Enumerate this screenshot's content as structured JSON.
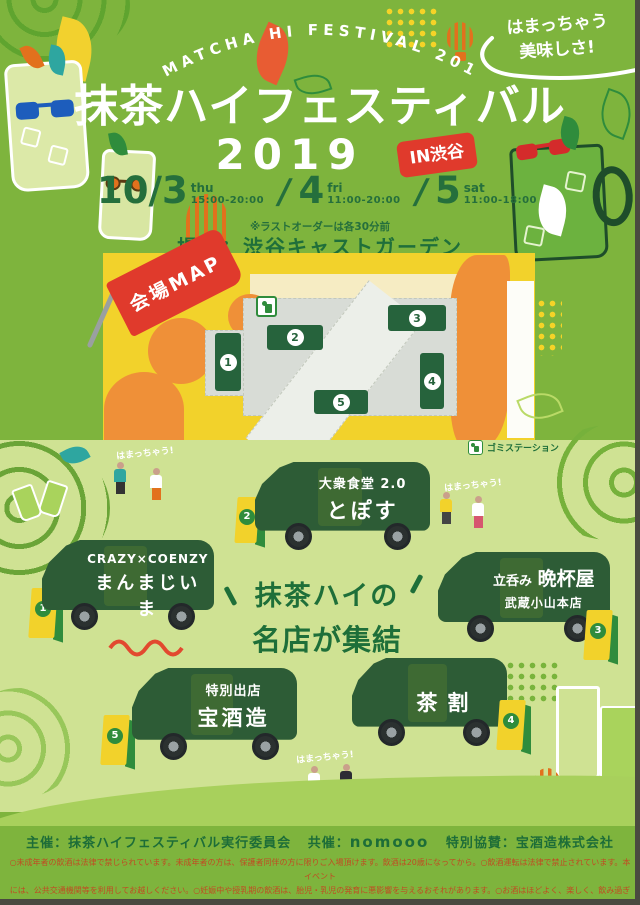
{
  "header": {
    "arch_text": "MATCHA HI FESTIVAL 2019",
    "bubble_line1": "はまっちゃう",
    "bubble_line2": "美味しさ!",
    "title": "抹茶ハイフェスティバル",
    "year": "2019",
    "location_badge": "IN渋谷",
    "dates": [
      {
        "day": "10/3",
        "weekday": "thu",
        "time": "15:00-20:00"
      },
      {
        "day": "4",
        "weekday": "fri",
        "time": "11:00-20:00"
      },
      {
        "day": "5",
        "weekday": "sat",
        "time": "11:00-18:00"
      }
    ],
    "date_separator": "/",
    "last_order_note": "※ラストオーダーは各30分前",
    "venue": "場所：渋谷キャストガーデン"
  },
  "map": {
    "flag_label": "会場MAP",
    "booths": [
      "1",
      "2",
      "3",
      "4",
      "5"
    ],
    "legend_label": "ゴミステーション"
  },
  "center_headline": {
    "line1": "抹茶ハイの",
    "line2": "名店が集結"
  },
  "catchphrase": "はまっちゃう!",
  "trucks": [
    {
      "number": "1",
      "line1": "CRAZY×COENZY",
      "line2": "まんまじいま"
    },
    {
      "number": "2",
      "line1": "大衆食堂 2.0",
      "line2": "とぽす"
    },
    {
      "number": "3",
      "prefix": "立呑み",
      "name": "晩杯屋",
      "sub": "武蔵小山本店"
    },
    {
      "number": "4",
      "line2": "茶割"
    },
    {
      "number": "5",
      "line1": "特別出店",
      "line2": "宝酒造"
    }
  ],
  "footer": {
    "credits_part1": "主催：抹茶ハイフェスティバル実行委員会",
    "credits_part2_label": "共催：",
    "credits_part2_value": "nomooo",
    "credits_part3": "特別協賛：宝酒造株式会社",
    "fine_print": [
      "○未成年者の飲酒は法律で禁じられています。未成年者の方は、保護者同伴の方に限りご入場頂けます。飲酒は20歳になってから。○飲酒運転は法律で禁止されています。本イベント",
      "には、公共交通機関等を利用してお越しください。○妊娠中や授乳期の飲酒は、胎児・乳児の発育に悪影響を与えるおそれがあります。○お酒はほどよく、楽しく、飲み過ぎに注意しましょう。",
      "○メディア取材、主催者による記録、広報等のため、イベントの写真撮影・録画・録音・オンライン配信、ソーシャルメディア配信等を行う場合がございますので、予めご了承ください。"
    ]
  },
  "colors": {
    "bg_green": "#7eb43d",
    "light_green": "#cfe293",
    "dark_green": "#1d6d38",
    "truck_green": "#2d5c36",
    "red": "#e03a2c",
    "yellow": "#f2d22b",
    "orange": "#ef9038",
    "fine_print_orange": "#c04c22"
  }
}
